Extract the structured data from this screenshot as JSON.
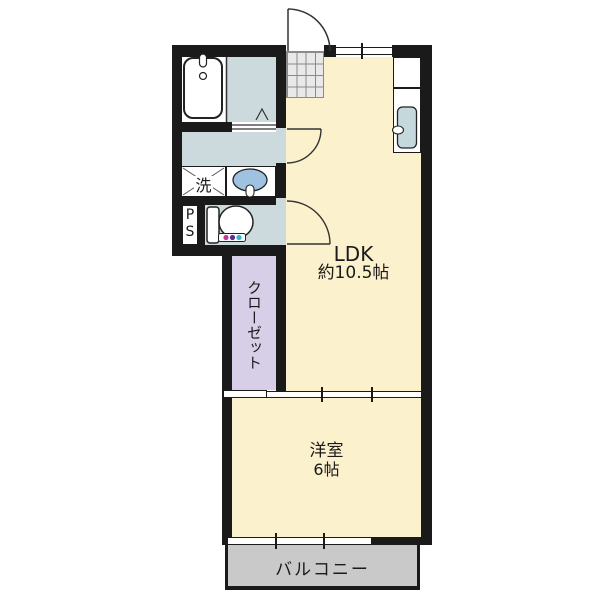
{
  "rooms": {
    "ldk": {
      "label": "LDK",
      "size": "約10.5帖"
    },
    "western_room": {
      "label": "洋室",
      "size": "6帖"
    },
    "closet": {
      "label": "クローゼット"
    },
    "balcony": {
      "label": "バルコニー"
    },
    "laundry_space": {
      "label": "洗"
    },
    "pipe_space": {
      "label": "PS"
    }
  },
  "colors": {
    "wall": "#1a1a1a",
    "room_floor": "#fcf1cd",
    "wet_area_floor": "#ccdade",
    "closet_floor": "#d7cfe7",
    "balcony_floor": "#c9c9c9",
    "entrance_tile": "#e9e9e9",
    "basin_bowl": "#9fc2e0",
    "kitchen_sink": "#c5d8dc",
    "washlet_dot_pink": "#bf3a96",
    "washlet_dot_purple": "#5c2f90",
    "washlet_dot_cyan": "#2fb9cd"
  },
  "icons": {
    "bathtub": "bathtub-icon",
    "wash_basin": "washbasin-icon",
    "toilet": "toilet-icon",
    "kitchen_sink": "kitchen-sink-icon",
    "washing_machine_pan": "washing-machine-pan-icon",
    "entrance_door": "door-swing-arc-icon",
    "folding_door": "folding-door-chevron-icon"
  }
}
